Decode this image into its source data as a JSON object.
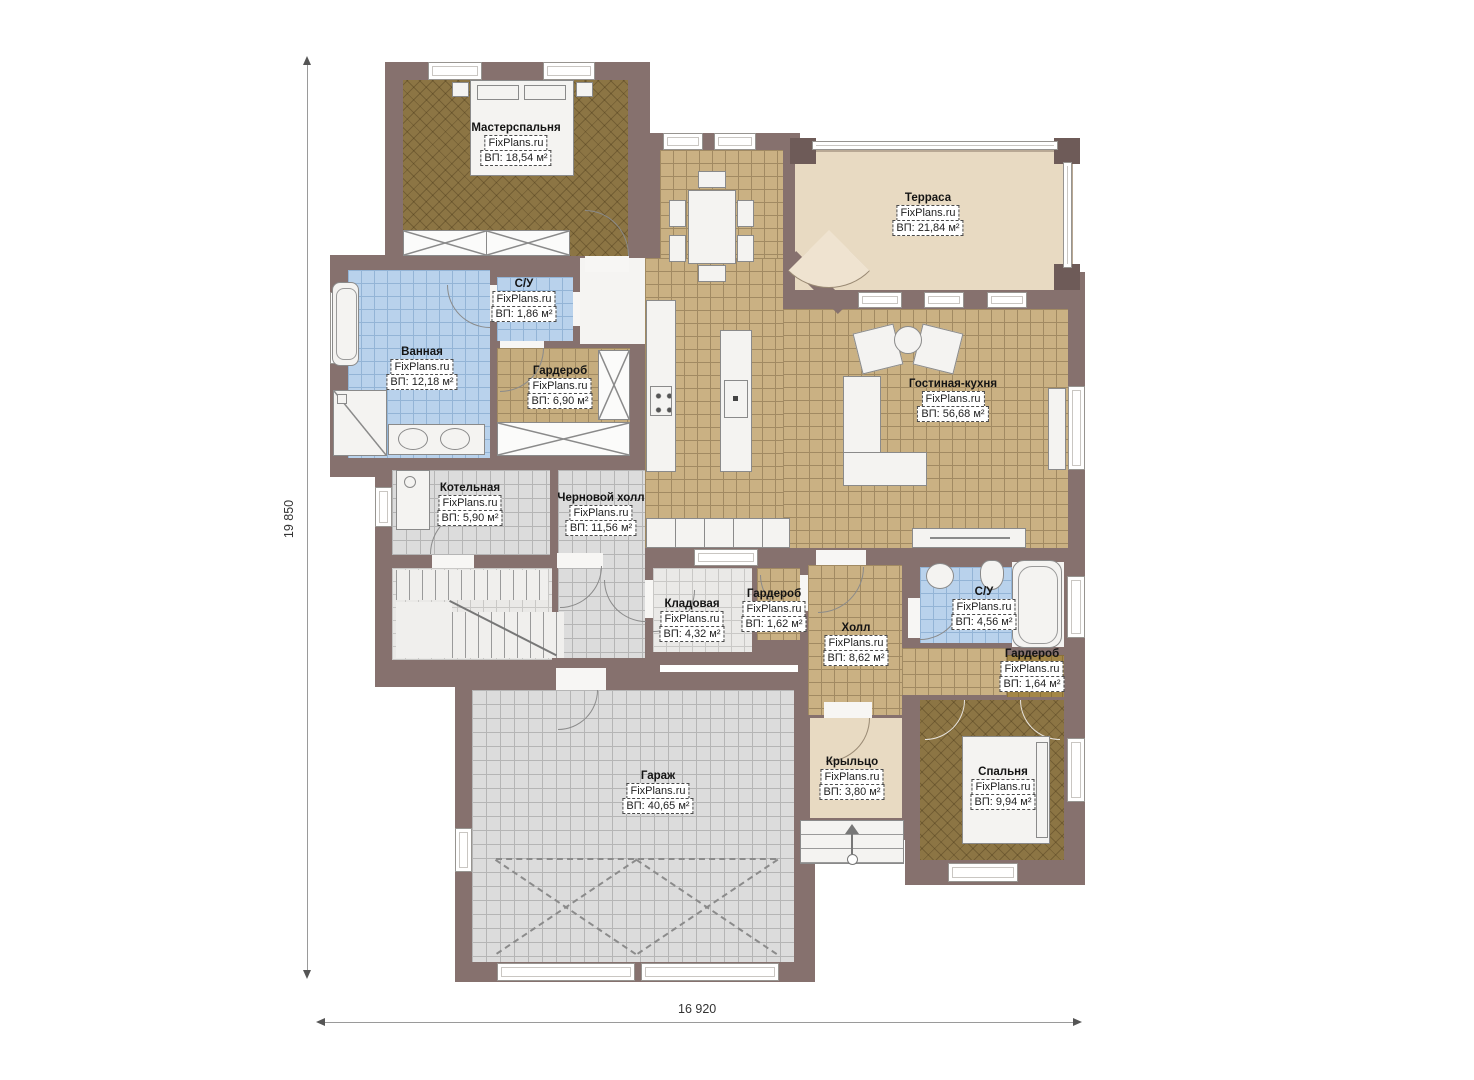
{
  "site": "FixPlans.ru",
  "dimensions": {
    "height_label": "19 850",
    "width_label": "16 920"
  },
  "colors": {
    "wall": "#86716e",
    "wall_dark": "#6e5b58",
    "tile": "#cab183",
    "dark_floor": "#8c7544",
    "bath_blue": "#b9d2ec",
    "terrace_beige": "#e8dac2",
    "garage_gray": "#dcdcdc"
  },
  "rooms": [
    {
      "id": "master-bedroom",
      "name": "Мастерспальня",
      "brand": "FixPlans.ru",
      "area": "ВП: 18,54 м²"
    },
    {
      "id": "wc-top",
      "name": "С/У",
      "brand": "FixPlans.ru",
      "area": "ВП: 1,86 м²"
    },
    {
      "id": "bathroom",
      "name": "Ванная",
      "brand": "FixPlans.ru",
      "area": "ВП: 12,18 м²"
    },
    {
      "id": "wardrobe-master",
      "name": "Гардероб",
      "brand": "FixPlans.ru",
      "area": "ВП: 6,90 м²"
    },
    {
      "id": "terrace",
      "name": "Терраса",
      "brand": "FixPlans.ru",
      "area": "ВП: 21,84 м²"
    },
    {
      "id": "living-kitchen",
      "name": "Гостиная-кухня",
      "brand": "FixPlans.ru",
      "area": "ВП: 56,68 м²"
    },
    {
      "id": "boiler",
      "name": "Котельная",
      "brand": "FixPlans.ru",
      "area": "ВП: 5,90 м²"
    },
    {
      "id": "rough-hall",
      "name": "Черновой холл",
      "brand": "FixPlans.ru",
      "area": "ВП: 11,56 м²"
    },
    {
      "id": "storage",
      "name": "Кладовая",
      "brand": "FixPlans.ru",
      "area": "ВП: 4,32 м²"
    },
    {
      "id": "wardrobe-small",
      "name": "Гардероб",
      "brand": "FixPlans.ru",
      "area": "ВП: 1,62 м²"
    },
    {
      "id": "hall",
      "name": "Холл",
      "brand": "FixPlans.ru",
      "area": "ВП: 8,62 м²"
    },
    {
      "id": "wc-right",
      "name": "С/У",
      "brand": "FixPlans.ru",
      "area": "ВП: 4,56 м²"
    },
    {
      "id": "wardrobe-right",
      "name": "Гардероб",
      "brand": "FixPlans.ru",
      "area": "ВП: 1,64 м²"
    },
    {
      "id": "bedroom",
      "name": "Спальня",
      "brand": "FixPlans.ru",
      "area": "ВП: 9,94 м²"
    },
    {
      "id": "porch",
      "name": "Крыльцо",
      "brand": "FixPlans.ru",
      "area": "ВП: 3,80 м²"
    },
    {
      "id": "garage",
      "name": "Гараж",
      "brand": "FixPlans.ru",
      "area": "ВП: 40,65 м²"
    }
  ]
}
